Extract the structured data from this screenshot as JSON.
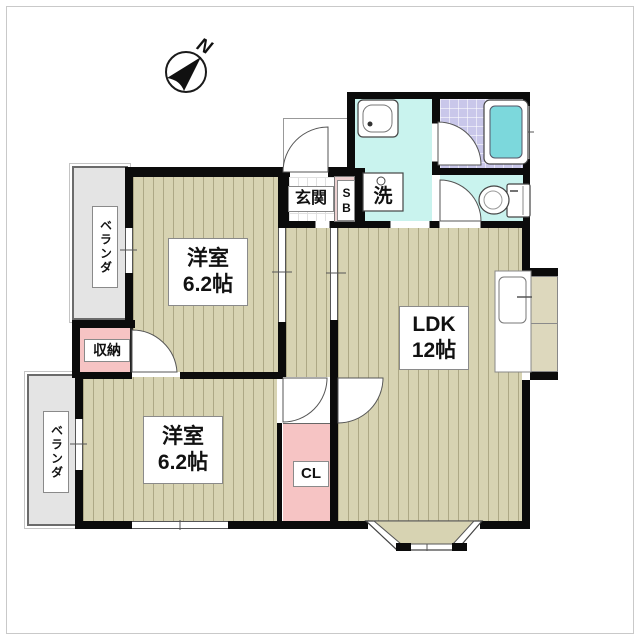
{
  "compass": {
    "label": "N"
  },
  "rooms": {
    "bedroom1": {
      "name": "洋室",
      "size": "6.2帖"
    },
    "bedroom2": {
      "name": "洋室",
      "size": "6.2帖"
    },
    "ldk": {
      "name": "LDK",
      "size": "12帖"
    },
    "entrance": {
      "label": "玄関"
    },
    "shoe_box": {
      "label": "SB"
    },
    "washer": {
      "label": "洗"
    },
    "storage": {
      "label": "収納"
    },
    "closet": {
      "label": "CL"
    },
    "balcony_top": {
      "label": "ベランダ"
    },
    "balcony_bottom": {
      "label": "ベランダ"
    }
  },
  "colors": {
    "wall": "#0b0b0b",
    "wood_floor": "#d7d3b2",
    "wood_stripe": "#7a734e",
    "wash_floor": "#c9f3ee",
    "bath_floor": "#c9c7ea",
    "bathtub": "#7cd8dc",
    "closet_pink": "#f6c4c4",
    "balcony_gray": "#e4e4e4"
  }
}
